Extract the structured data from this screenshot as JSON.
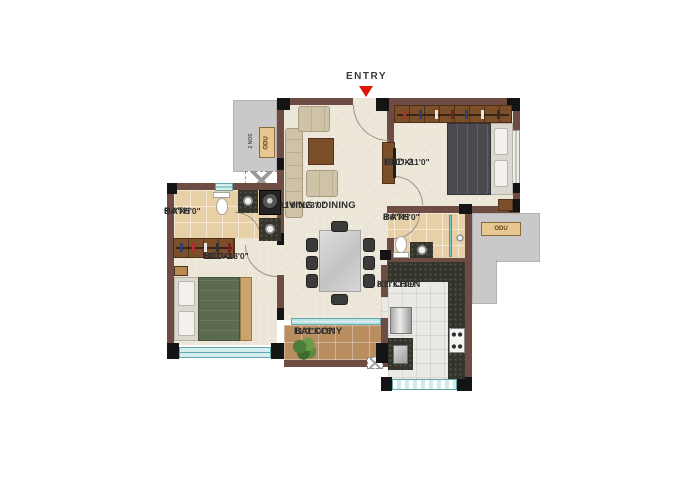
{
  "plan_title": "2 BHK floor plan",
  "entry": {
    "label": "ENTRY"
  },
  "rooms": {
    "living": {
      "name": "LIVING / DINING",
      "dims": "11'0\"X23'0\""
    },
    "bed2": {
      "name": "BED-2",
      "dims": "13'0\"X11'0\""
    },
    "bed1": {
      "name": "BED-1",
      "dims": "11'0\"X13'0\""
    },
    "bath1": {
      "name": "BATH",
      "dims": "9'4\"X5'0\""
    },
    "bath2": {
      "name": "BATH",
      "dims": "8'6\"X5'0\""
    },
    "kitchen": {
      "name": "KITCHEN",
      "dims": "8'2\"X13'0\""
    },
    "balcony": {
      "name": "BALCONY",
      "dims": "11'0\"X4'6\""
    }
  },
  "annotations": {
    "odu_left": "ODU",
    "odu_left_qty": "2 NOS",
    "odu_right": "ODU"
  },
  "colors": {
    "wall": "#6f4c43",
    "column": "#141414",
    "floor_cream": "#ece6d9",
    "bath_tile": "#e8d0a6",
    "balcony_tile": "#b88e61",
    "kitchen_floor": "#ebe9e3",
    "granite_counter": "#34332c",
    "window_teal": "#9fd4d6",
    "exterior_gray": "#c9c9c9",
    "wardrobe_wood": "#7c4f2b",
    "bed1_blanket": "#5c6b50",
    "bed2_blanket": "#4a4a50",
    "sofa_beige": "#cec2a7",
    "entry_arrow_red": "#e01407",
    "label_text": "#303030"
  }
}
